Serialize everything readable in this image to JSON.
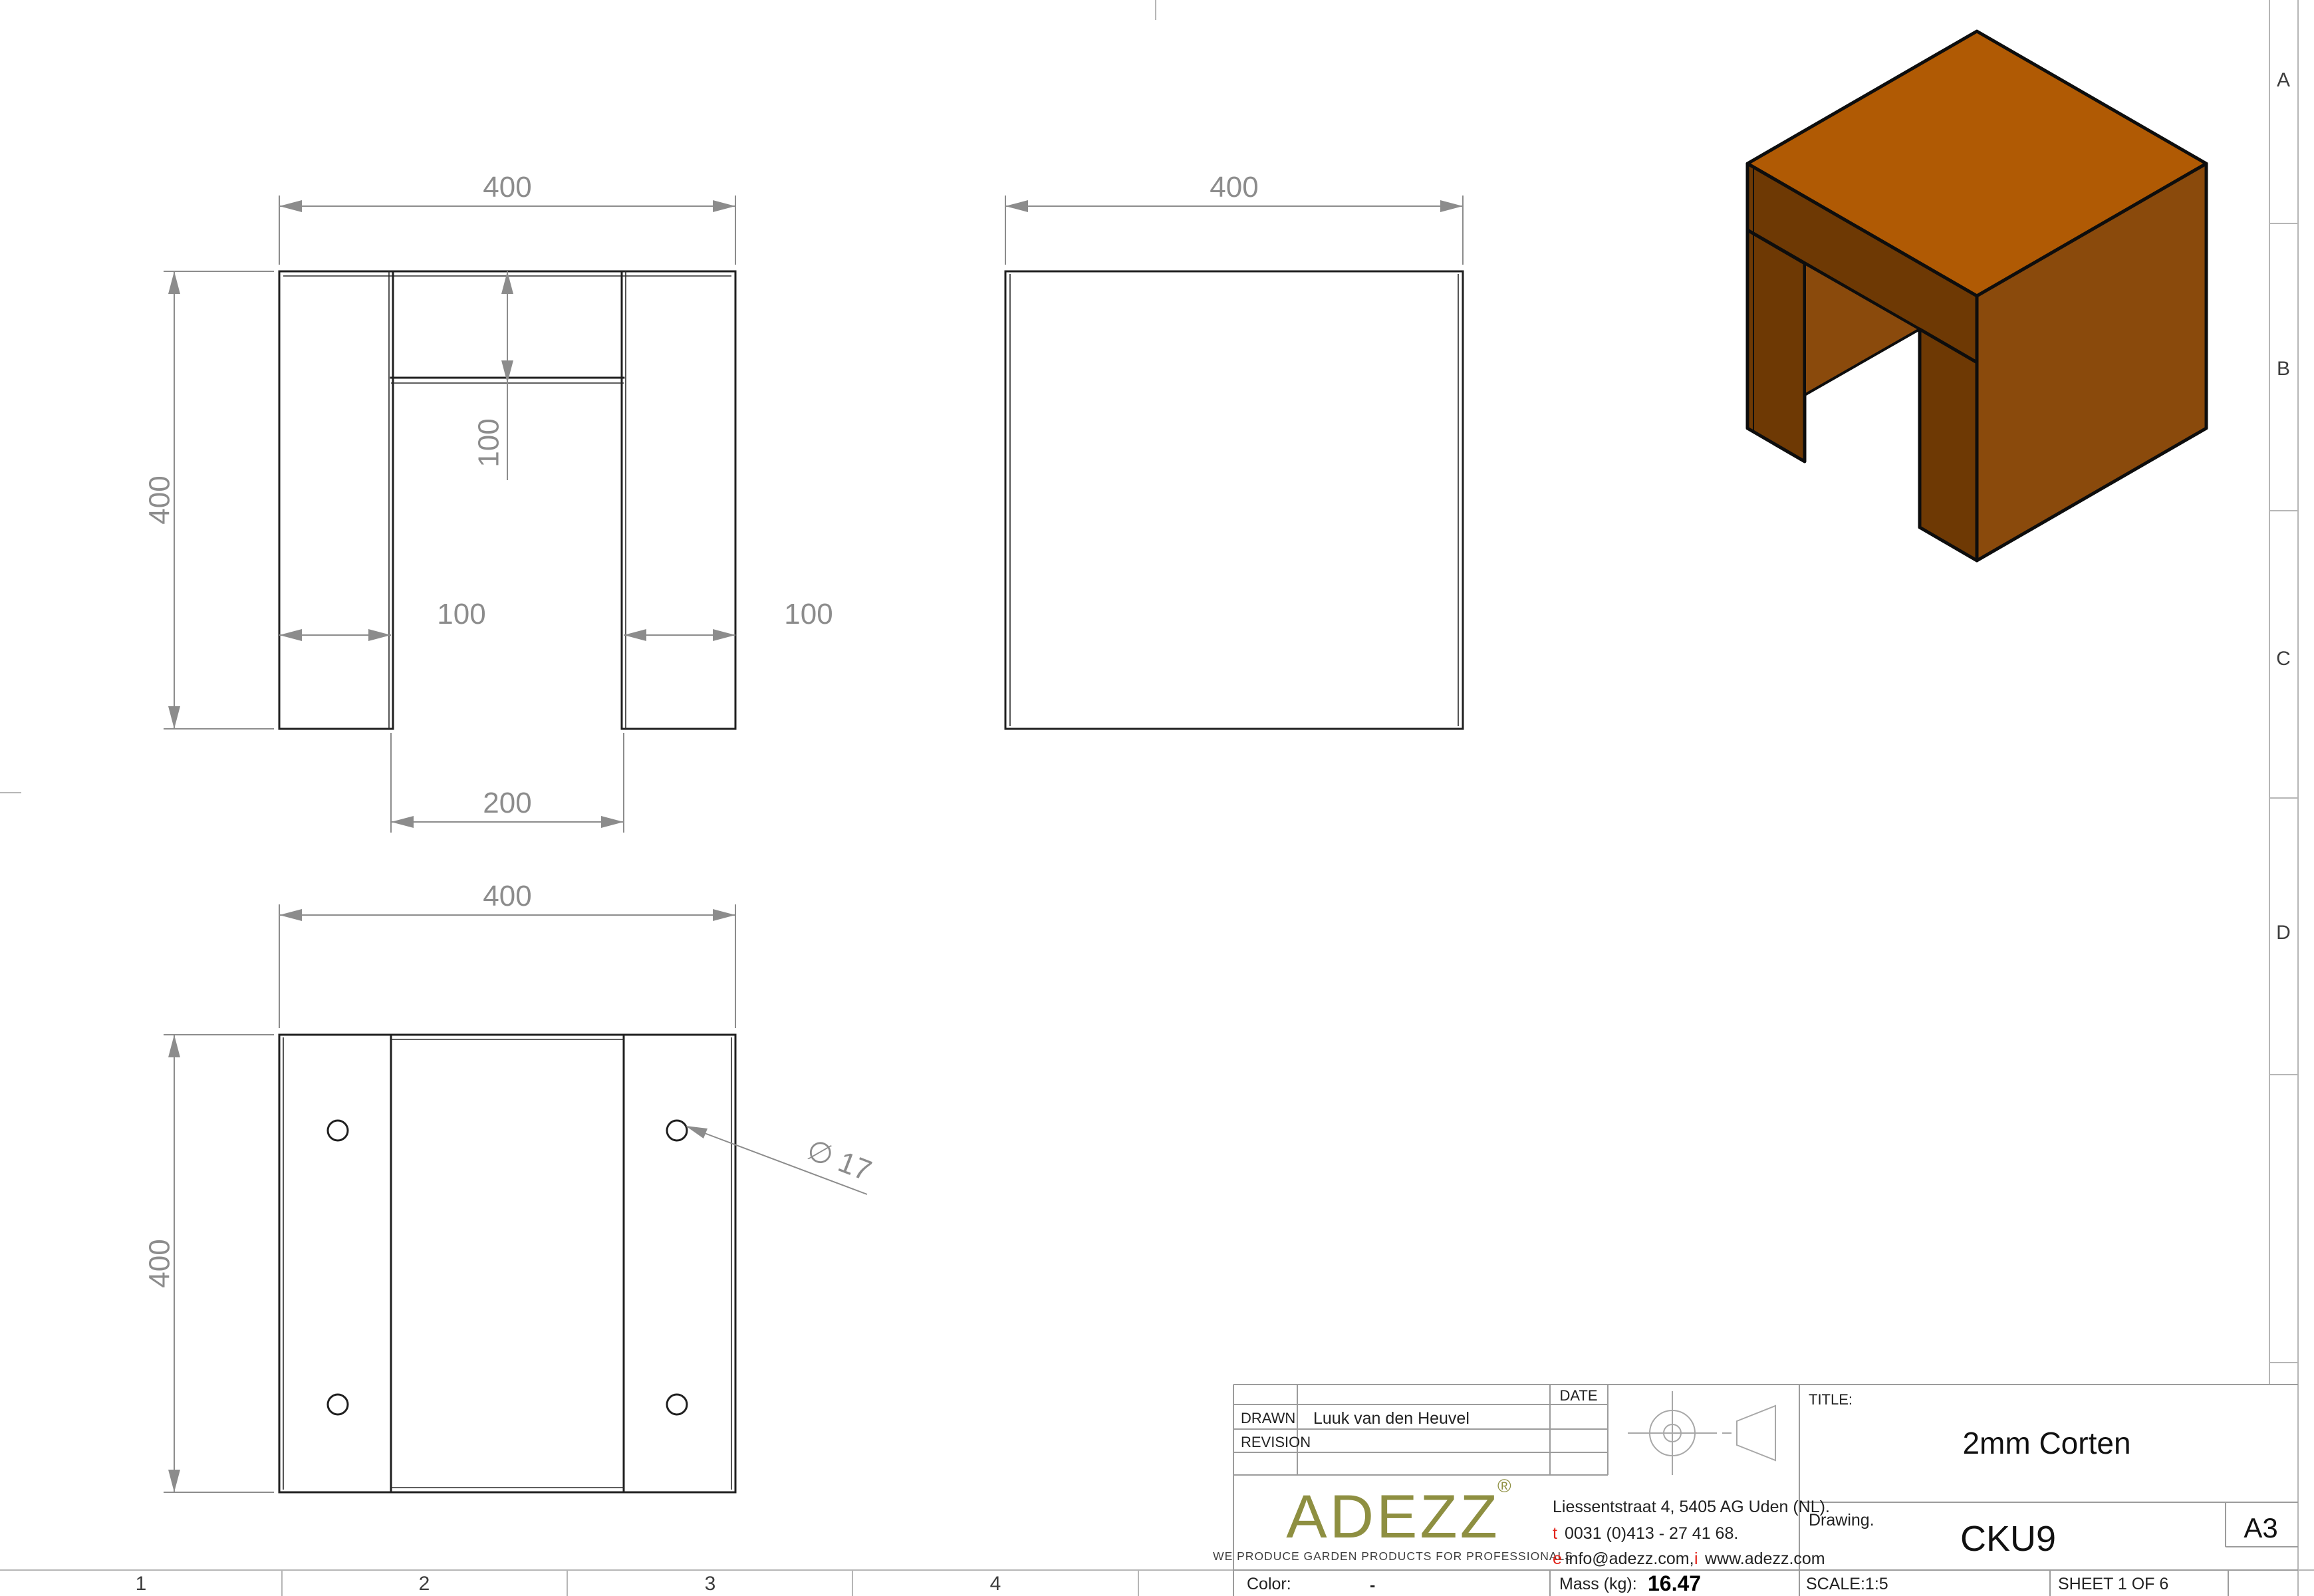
{
  "frame": {
    "zone_letters": [
      "A",
      "B",
      "C",
      "D"
    ],
    "zone_numbers": [
      "1",
      "2",
      "3",
      "4"
    ]
  },
  "views": {
    "front": {
      "width": "400",
      "height": "400",
      "top_depth": "100",
      "leg_left": "100",
      "leg_right": "100",
      "opening": "200"
    },
    "side": {
      "width": "400"
    },
    "bottom": {
      "width": "400",
      "height": "400",
      "hole_diameter": "∅ 17"
    }
  },
  "title_block": {
    "drawn_label": "DRAWN",
    "drawn_value": "Luuk van den Heuvel",
    "revision_label": "REVISION",
    "date_label": "DATE",
    "title_label": "TITLE:",
    "title_value": "2mm Corten",
    "drawing_label": "Drawing.",
    "drawing_value": "CKU9",
    "paper_size": "A3",
    "scale": "SCALE:1:5",
    "sheet": "SHEET 1 OF 6",
    "color_label": "Color:",
    "color_value": "-",
    "mass_label": "Mass (kg):",
    "mass_value": "16.47",
    "logo_text": "ADEZZ",
    "logo_reg": "®",
    "logo_tagline": "WE PRODUCE GARDEN PRODUCTS FOR PROFESSIONALS",
    "address": "Liessentstraat 4, 5405 AG Uden (NL).",
    "phone_prefix": "t",
    "phone": "0031 (0)413 - 27 41 68.",
    "email_prefix": "e",
    "email": "info@adezz.com,",
    "web_prefix": "i",
    "web": "www.adezz.com"
  },
  "colors": {
    "corten_top": "#B05A04",
    "corten_right": "#8A4A0C",
    "corten_dark": "#6E3904",
    "logo_olive": "#8E8F41",
    "accent_red": "#E2231A",
    "dim_gray": "#8C8C8C",
    "line_dark": "#1F1F1F",
    "frame_gray": "#B6B6B6"
  }
}
